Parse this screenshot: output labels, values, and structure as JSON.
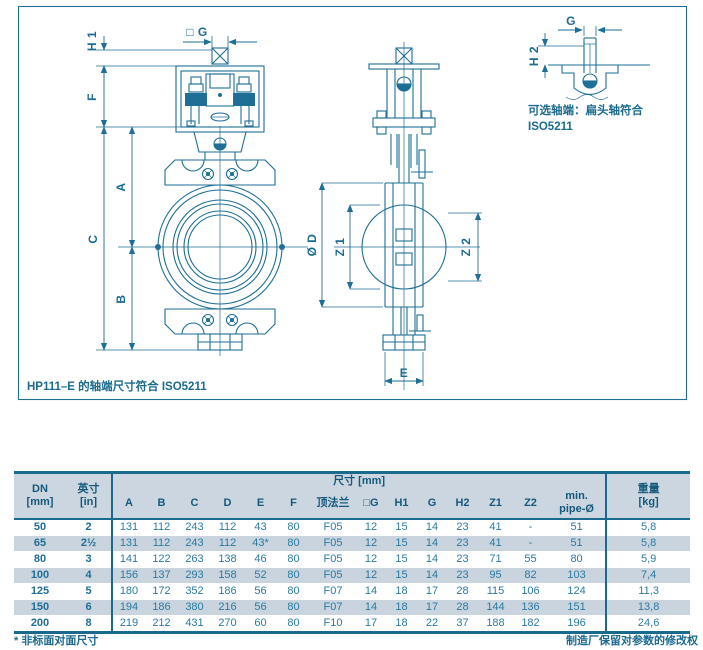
{
  "colors": {
    "accent": "#1a6a8e",
    "line": "#1e6e96",
    "header_bg": "#ccd6e0",
    "row_alt_bg": "#c9d4de",
    "data_text": "#2b7aa1"
  },
  "drawing": {
    "frame_note": "HP111–E 的轴端尺寸符合 ISO5211",
    "inset": {
      "line1": "可选轴端：扁头轴符合",
      "line2": "ISO5211"
    },
    "labels": {
      "h1": "H 1",
      "sq_g": "□ G",
      "f": "F",
      "a": "A",
      "c": "C",
      "b": "B",
      "dia_d": "Ø D",
      "z1": "Z 1",
      "z2": "Z 2",
      "e": "E",
      "g": "G",
      "h2": "H 2"
    }
  },
  "table": {
    "header": {
      "dn": "DN\n[mm]",
      "inch": "英寸\n[in]",
      "size_group": "尺寸 [mm]",
      "cols": [
        "A",
        "B",
        "C",
        "D",
        "E",
        "F",
        "顶法兰",
        "□G",
        "H1",
        "G",
        "H2",
        "Z1",
        "Z2",
        "min.\npipe-Ø"
      ],
      "weight": "重量\n[kg]"
    },
    "rows": [
      {
        "dn": "50",
        "inch": "2",
        "values": [
          "131",
          "112",
          "243",
          "112",
          "43",
          "80",
          "F05",
          "12",
          "15",
          "14",
          "23",
          "41",
          "-",
          "51"
        ],
        "weight": "5,8"
      },
      {
        "dn": "65",
        "inch": "2½",
        "values": [
          "131",
          "112",
          "243",
          "112",
          "43*",
          "80",
          "F05",
          "12",
          "15",
          "14",
          "23",
          "41",
          "-",
          "51"
        ],
        "weight": "5,8"
      },
      {
        "dn": "80",
        "inch": "3",
        "values": [
          "141",
          "122",
          "263",
          "138",
          "46",
          "80",
          "F05",
          "12",
          "15",
          "14",
          "23",
          "71",
          "55",
          "80"
        ],
        "weight": "5,9"
      },
      {
        "dn": "100",
        "inch": "4",
        "values": [
          "156",
          "137",
          "293",
          "158",
          "52",
          "80",
          "F05",
          "12",
          "15",
          "14",
          "23",
          "95",
          "82",
          "103"
        ],
        "weight": "7,4"
      },
      {
        "dn": "125",
        "inch": "5",
        "values": [
          "180",
          "172",
          "352",
          "186",
          "56",
          "80",
          "F07",
          "14",
          "18",
          "17",
          "28",
          "115",
          "106",
          "124"
        ],
        "weight": "11,3"
      },
      {
        "dn": "150",
        "inch": "6",
        "values": [
          "194",
          "186",
          "380",
          "216",
          "56",
          "80",
          "F07",
          "14",
          "18",
          "17",
          "28",
          "144",
          "136",
          "151"
        ],
        "weight": "13,8"
      },
      {
        "dn": "200",
        "inch": "8",
        "values": [
          "219",
          "212",
          "431",
          "270",
          "60",
          "80",
          "F10",
          "17",
          "18",
          "22",
          "37",
          "188",
          "182",
          "196"
        ],
        "weight": "24,6"
      }
    ],
    "footnote_left": "* 非标面对面尺寸",
    "footnote_right": "制造厂保留对参数的修改权"
  }
}
